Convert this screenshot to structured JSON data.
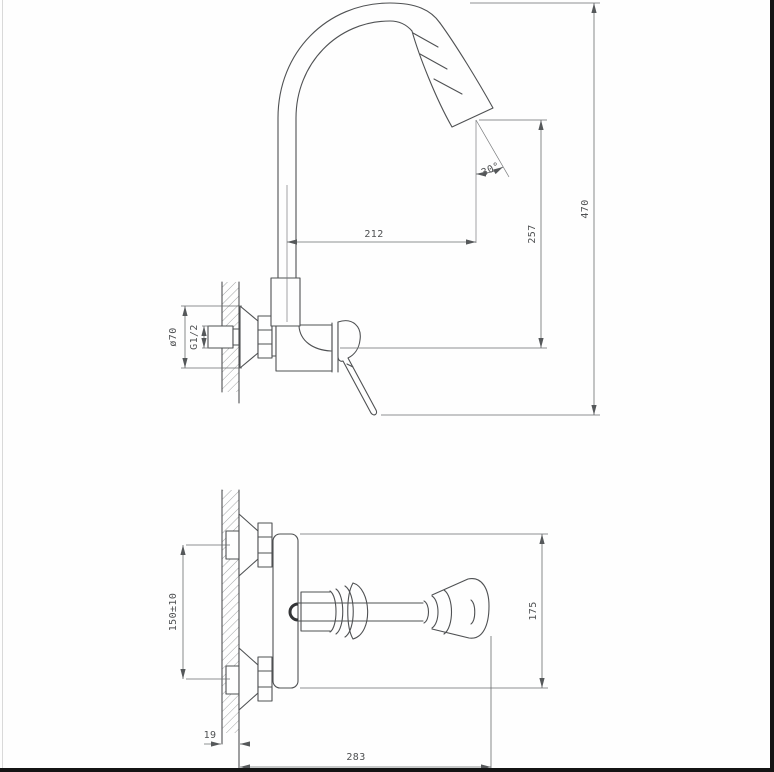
{
  "drawing": {
    "subject": "wall-mounted kitchen faucet installation dimensions, two orthographic views",
    "colors": {
      "line": "#4f5153",
      "dimension_line": "#6a6c6e",
      "hatch": "#8a8c8e",
      "background": "#fefefe",
      "border_bar": "#141414"
    },
    "dims": {
      "spout_reach": "212",
      "tip_height": "257",
      "overall_height": "470",
      "spray_angle": "30°",
      "flange_diameter": "ø70",
      "thread_size": "G1/2",
      "inlet_spacing": "150±10",
      "body_span": "175",
      "wall_thickness": "19",
      "overall_depth": "283"
    }
  }
}
